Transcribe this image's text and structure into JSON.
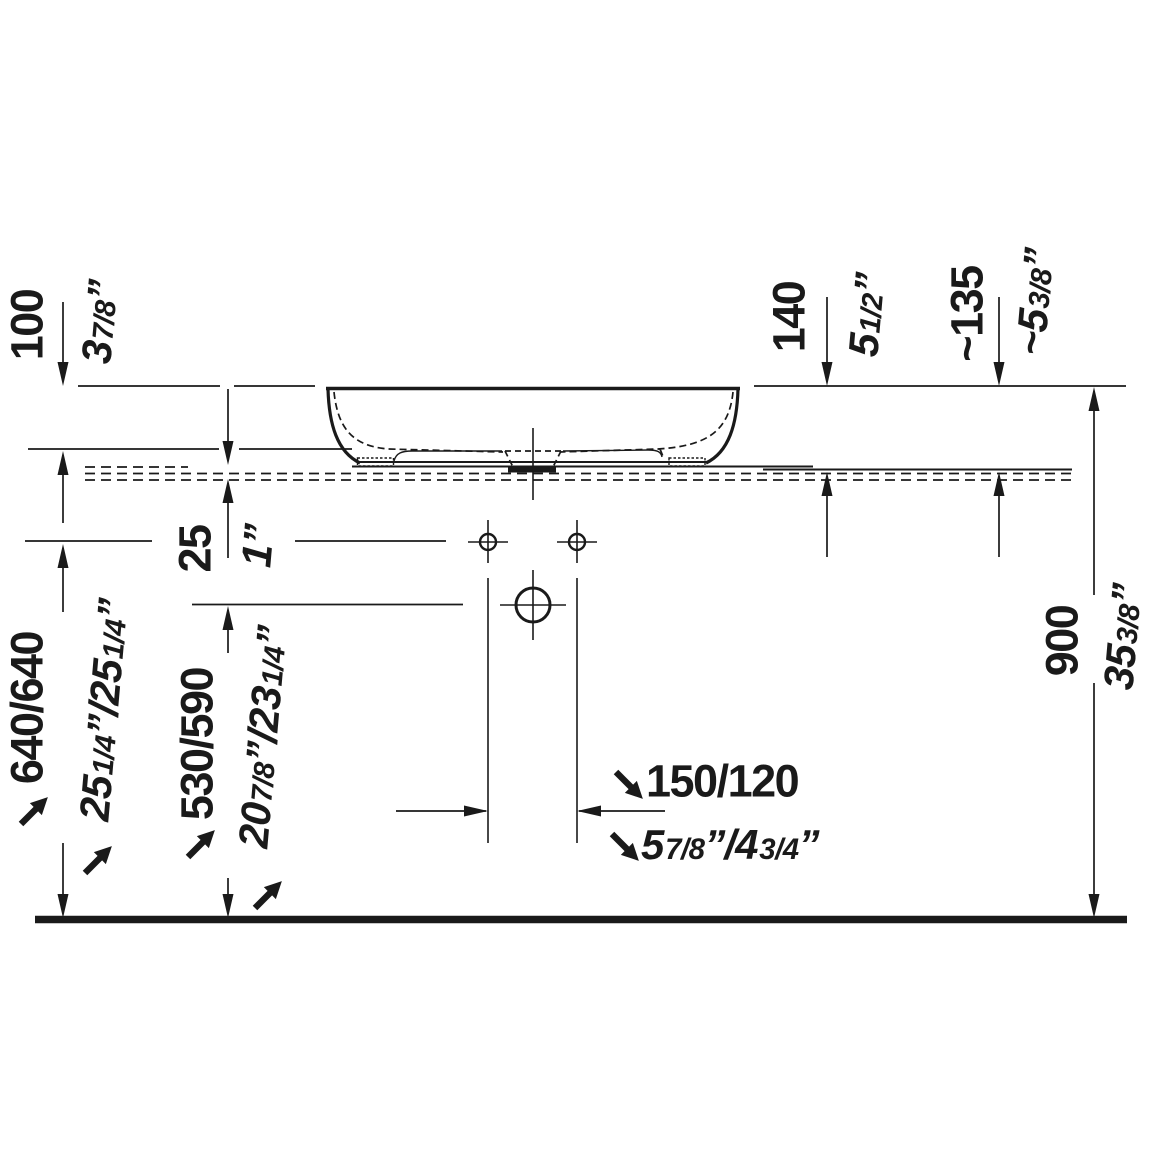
{
  "drawing": {
    "title": "Countertop washbasin side elevation with installation dimensions",
    "line_color": "#1a1a1a",
    "background": "#ffffff",
    "units": "mm / inch"
  },
  "dims": {
    "rim_offset": {
      "mm": "100",
      "inch_parts": [
        "3",
        "7/8",
        "”"
      ]
    },
    "basin_height": {
      "mm": "140",
      "inch_parts": [
        "5",
        "1/2",
        "”"
      ]
    },
    "basin_height_approx": {
      "mm": "~135",
      "inch_parts": [
        "~5",
        "3/8",
        "”"
      ]
    },
    "counter_thickness": {
      "mm": "25",
      "inch_parts": [
        "1",
        "”"
      ]
    },
    "rim_to_floor": {
      "mm": "640/640",
      "inch_parts": [
        "25",
        "1/4",
        "”/",
        "25",
        "1/4",
        "”"
      ]
    },
    "outlet_to_floor": {
      "mm": "530/590",
      "inch_parts": [
        "20",
        "7/8",
        "”/",
        "23",
        "1/4",
        "”"
      ]
    },
    "tap_hole_distance": {
      "mm": "150/120",
      "inch_parts": [
        "5",
        "7/8",
        "”/",
        "4",
        "3/4",
        "”"
      ]
    },
    "counter_to_floor": {
      "mm": "900",
      "inch_parts": [
        "35",
        "3/8",
        "”"
      ]
    }
  }
}
